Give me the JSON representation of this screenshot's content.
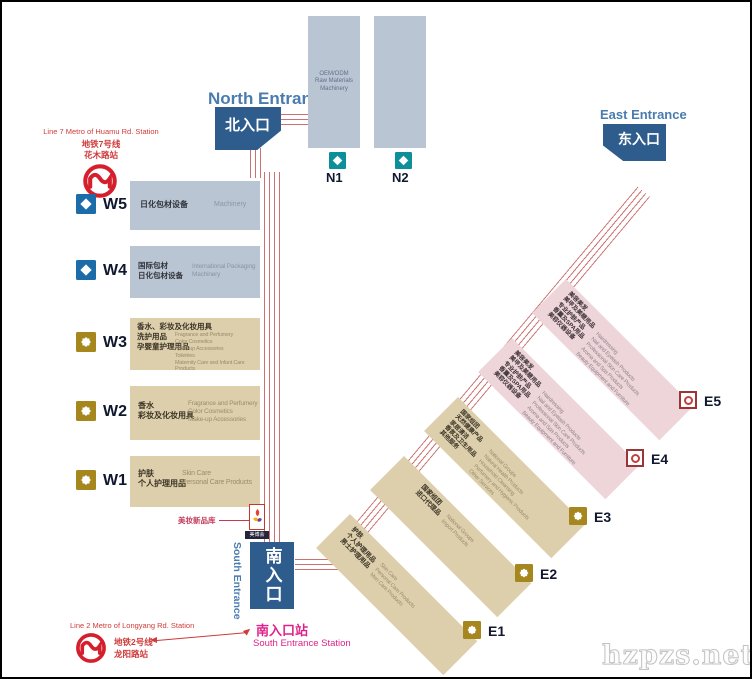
{
  "watermark": "hzpzs.net",
  "entrances": {
    "north": {
      "en": "North Entrance",
      "zh": "北入口"
    },
    "east": {
      "en": "East Entrance",
      "zh": "东入口"
    },
    "south": {
      "en": "South Entrance",
      "zh": "南入口"
    }
  },
  "metro_line7": {
    "en": "Line 7 Metro of Huamu Rd. Station",
    "zh_line": "地铁7号线",
    "zh_station": "花木路站"
  },
  "metro_line2": {
    "en": "Line 2 Metro of Longyang Rd. Station",
    "zh_line": "地铁2号线",
    "zh_station": "龙阳路站"
  },
  "south_station": {
    "zh": "南入口站",
    "en": "South Entrance Station"
  },
  "new_products": {
    "annotation": "美妆新品库",
    "logo_label": "美博会"
  },
  "halls": {
    "n": [
      {
        "id": "N1",
        "desc_en": "OEM/ODM\nRaw Materials\nMachinery"
      },
      {
        "id": "N2",
        "desc_en": ""
      }
    ],
    "w": [
      {
        "id": "W5",
        "zh": "日化包材设备",
        "en": "Machinery"
      },
      {
        "id": "W4",
        "zh": "国际包材\n日化包材设备",
        "en": "International Packaging\nMachinery"
      },
      {
        "id": "W3",
        "zh": "香水、彩妆及化妆用具\n洗护用品\n孕婴童护理用品",
        "en": "Fragrance and Perfumery\nColor Cosmetics\nMake-up Accessories\nToiletries\nMaternity Care and Infant Care Products"
      },
      {
        "id": "W2",
        "zh": "香水\n彩妆及化妆用具",
        "en": "Fragrance and Perfumery\nColor Cosmetics\nMake-up Accessories"
      },
      {
        "id": "W1",
        "zh": "护肤\n个人护理用品",
        "en": "Skin Care\nPersonal Care Products"
      }
    ],
    "e": [
      {
        "id": "E1",
        "zh": "护肤\n个人护理用品\n男士护理用品",
        "en": "Skin Care\nPersonal Care Products\nMen Care Products"
      },
      {
        "id": "E2",
        "zh": "国家组团\n进口代理品",
        "en": "National Groups\nImport Products"
      },
      {
        "id": "E3",
        "zh": "国家组团\n天然健康产品\n家居清洁\n香氛及卫生用品\n其他服务",
        "en": "National Groups\nNatural Health Products\nHousehold Cleansing\nPerfumery and Hygienic Products\nOther Services"
      },
      {
        "id": "E4",
        "zh": "美容美发\n美甲及美睫用品\n专业护肤产品\n香薰及SPA用品\n美容仪器设备",
        "en": "Hairdressing\nNail and Eyelash Products\nProfessional Skin Care Products\nAroma and Spa Products\nBeauty Equipment and Furniture"
      },
      {
        "id": "E5",
        "zh": "美容美发\n美甲及美睫用品\n专业护肤产品\n香薰及SPA用品\n美容仪器设备",
        "en": "Hairdressing\nNail and Eyelash Products\nProfessional Skin Care Products\nAroma and Spa Products\nBeauty Equipment and Furniture"
      }
    ]
  },
  "colors": {
    "entrance_blue": "#2e5d8d",
    "entrance_label_blue": "#4a7cb0",
    "hall_blue": "#bac5d3",
    "hall_tan": "#decfac",
    "hall_pink": "#eed5da",
    "corridor_red": "#cc7070",
    "magenta": "#e0218a",
    "metro_red": "#d51f2c",
    "icon_gold": "#a5871e",
    "icon_teal": "#0d8f9b",
    "icon_blue": "#1b6ca8"
  }
}
